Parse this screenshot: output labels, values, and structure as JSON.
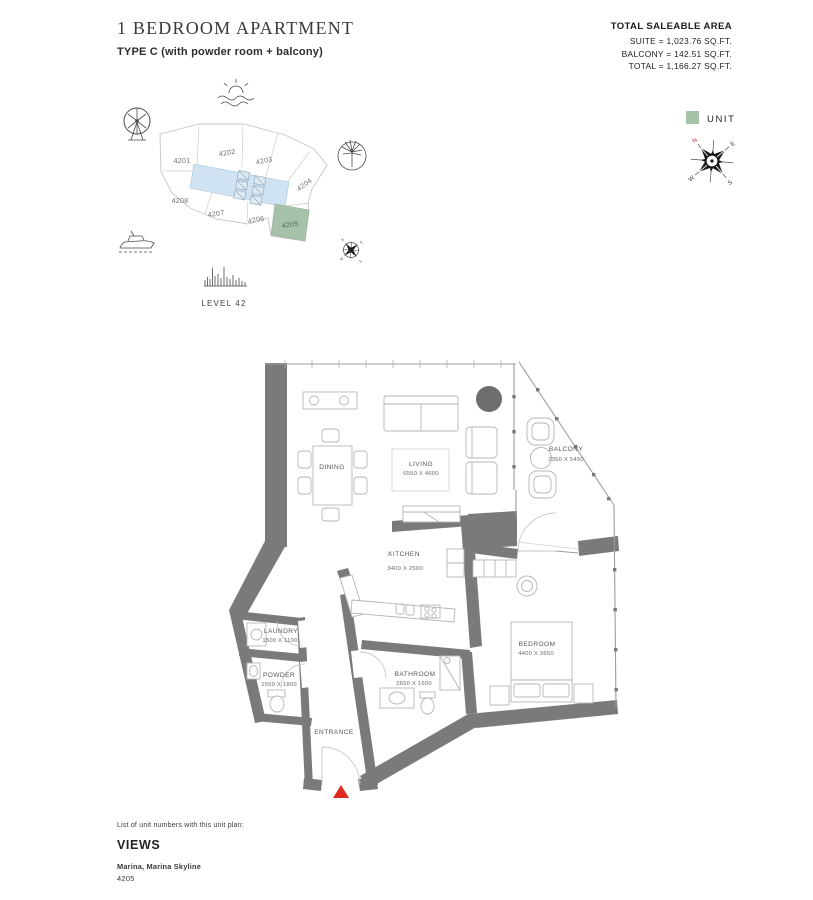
{
  "header": {
    "title": "1 BEDROOM APARTMENT",
    "subtitle": "TYPE C (with powder room + balcony)",
    "area_summary": {
      "heading": "TOTAL SALEABLE AREA",
      "suite": "SUITE = 1,023.76 SQ.FT.",
      "balcony": "BALCONY = 142.51 SQ.FT.",
      "total": "TOTAL = 1,166.27 SQ.FT."
    }
  },
  "key_plan": {
    "level_label": "LEVEL 42",
    "units": {
      "u4201": "4201",
      "u4202": "4202",
      "u4203": "4203",
      "u4204": "4204",
      "u4205": "4205",
      "u4206": "4206",
      "u4207": "4207",
      "u4208": "4208"
    },
    "highlighted_unit": "4205",
    "unit_color": "#a6c3aa",
    "core_color": "#cfe3f2"
  },
  "legend": {
    "unit_label": "UNIT",
    "swatch_color": "#a6c3aa"
  },
  "compass": {
    "north": "N",
    "east": "E",
    "south": "S",
    "west": "W"
  },
  "floor_plan": {
    "wall_color": "#7a7a7a",
    "entrance_marker_color": "#e02b20",
    "rooms": {
      "dining": {
        "name": "DINING"
      },
      "living": {
        "name": "LIVING",
        "dims": "6550 X 4600"
      },
      "kitchen": {
        "name": "KITCHEN",
        "dims": "3400 X 2500"
      },
      "balcony": {
        "name": "BALCONY",
        "dims": "2350 X 5450"
      },
      "laundry": {
        "name": "LAUNDRY",
        "dims": "1500 X 1100"
      },
      "powder": {
        "name": "POWDER",
        "dims": "1550 X 1800"
      },
      "bathroom": {
        "name": "BATHROOM",
        "dims": "2650 X 1600"
      },
      "bedroom": {
        "name": "BEDROOM",
        "dims": "4400 X 3650"
      },
      "entrance": {
        "name": "ENTRANCE"
      }
    }
  },
  "footer": {
    "list_label": "List of unit numbers with this unit plan:",
    "views_heading": "VIEWS",
    "views_value": "Marina, Marina Skyline",
    "unit_number": "4205"
  }
}
